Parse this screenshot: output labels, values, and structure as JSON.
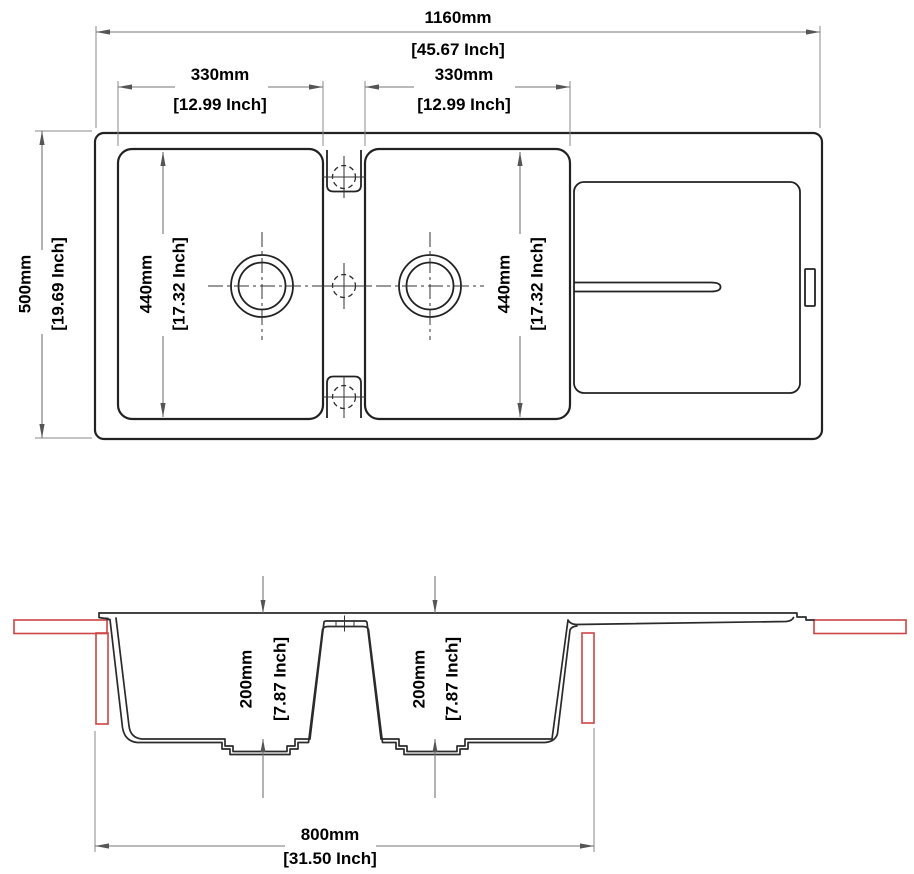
{
  "drawing_title": "Double bowl kitchen sink with drainboard - dimension drawing",
  "colors": {
    "line": "#222222",
    "dimension": "#757575",
    "text": "#000000",
    "accent_red": "#cc4444"
  },
  "top_view": {
    "overall_width": {
      "mm": "1160mm",
      "inch": "[45.67 Inch]"
    },
    "left_bowl_width": {
      "mm": "330mm",
      "inch": "[12.99 Inch]"
    },
    "right_bowl_width": {
      "mm": "330mm",
      "inch": "[12.99 Inch]"
    },
    "overall_depth": {
      "mm": "500mm",
      "inch": "[19.69 Inch]"
    },
    "left_bowl_length": {
      "mm": "440mm",
      "inch": "[17.32 Inch]"
    },
    "right_bowl_length": {
      "mm": "440mm",
      "inch": "[17.32 Inch]"
    }
  },
  "section_view": {
    "left_bowl_depth": {
      "mm": "200mm",
      "inch": "[7.87 Inch]"
    },
    "right_bowl_depth": {
      "mm": "200mm",
      "inch": "[7.87 Inch]"
    },
    "cabinet_width": {
      "mm": "800mm",
      "inch": "[31.50 Inch]"
    }
  }
}
